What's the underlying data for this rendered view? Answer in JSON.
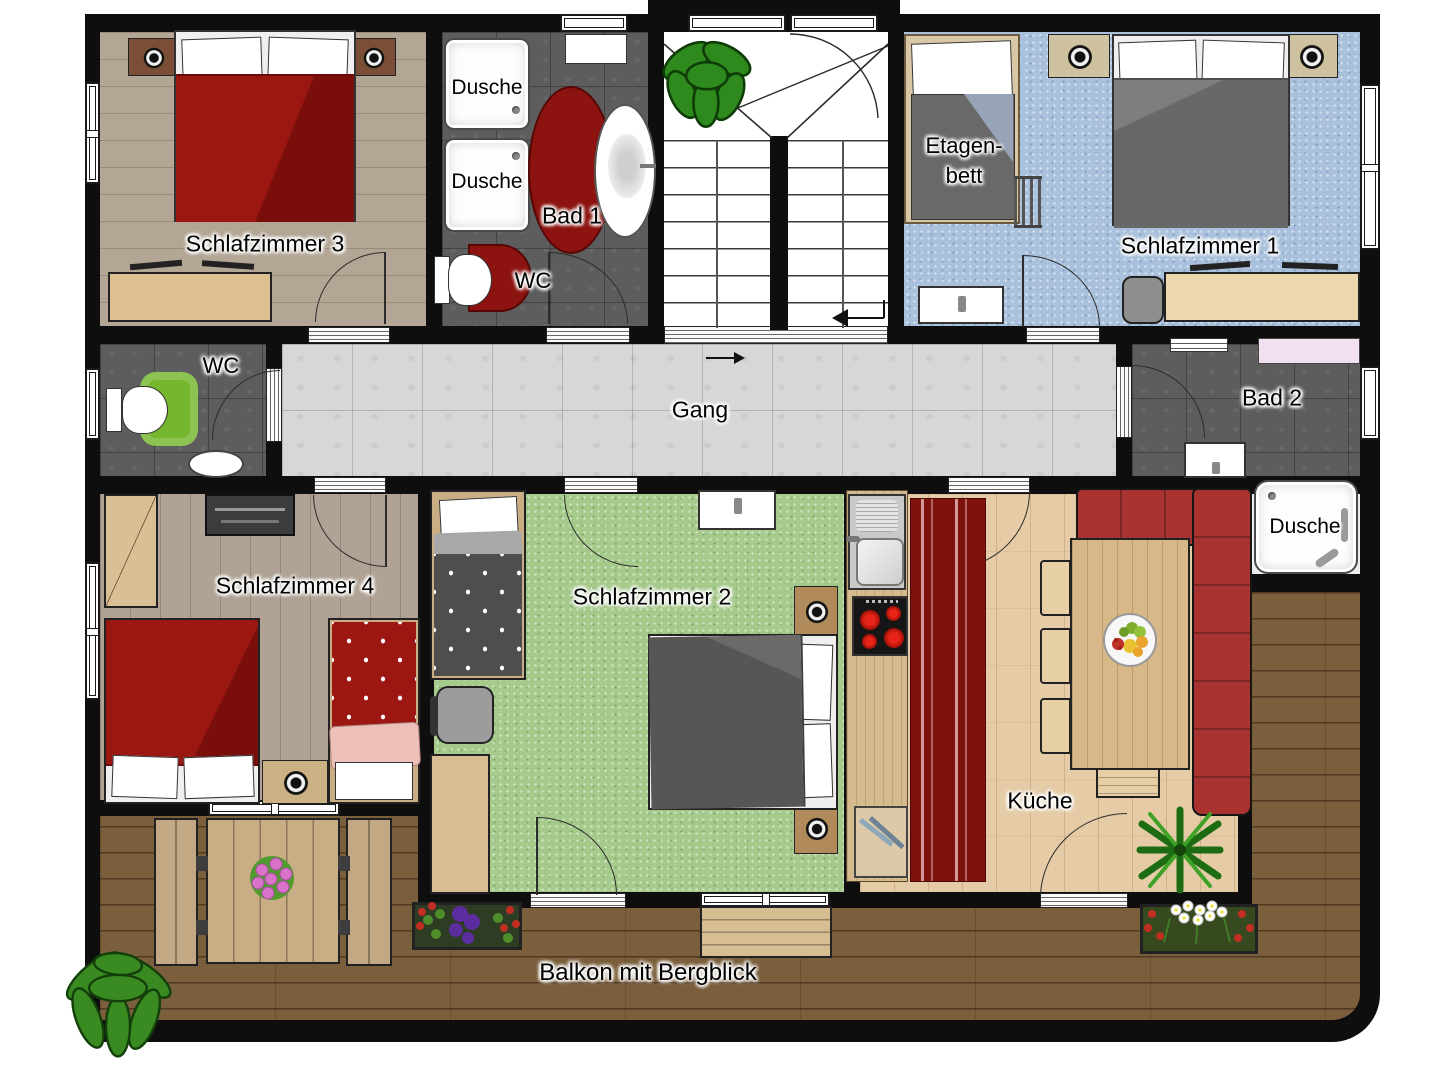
{
  "title": "Obergeschoss Grundriss (floor plan)",
  "labels": {
    "schlafzimmer1": "Schlafzimmer 1",
    "schlafzimmer2": "Schlafzimmer 2",
    "schlafzimmer3": "Schlafzimmer 3",
    "schlafzimmer4": "Schlafzimmer 4",
    "bad1": "Bad 1",
    "bad2": "Bad 2",
    "wc_bad1": "WC",
    "wc_room": "WC",
    "dusche_top": "Dusche",
    "dusche_bottom": "Dusche",
    "dusche_room": "Dusche",
    "etagenbett_line1": "Etagen-",
    "etagenbett_line2": "bett",
    "gang": "Gang",
    "kueche": "Küche",
    "balkon": "Balkon mit Bergblick"
  },
  "colors": {
    "wall": "#0e0e0e",
    "bedroom3_floor": "#b3a695",
    "bedroom4_floor": "#b0a294",
    "bedroom1_carpet": "#a9c1dc",
    "bedroom2_carpet": "#a6ca8c",
    "bath_tile": "#5d5d5d",
    "corridor_marble": "#d7d7d5",
    "kitchen_wood": "#e5cca7",
    "balcony_deck": "#7b5e3c",
    "bed_red": "#8e1410",
    "bed_gray": "#6e6e6e",
    "sofa_red": "#a83330",
    "rug_red": "#7e120d",
    "toilet_rug_green": "#74b62c",
    "stove_burner_red": "#cc1410",
    "plant_green": "#3a8a22"
  }
}
